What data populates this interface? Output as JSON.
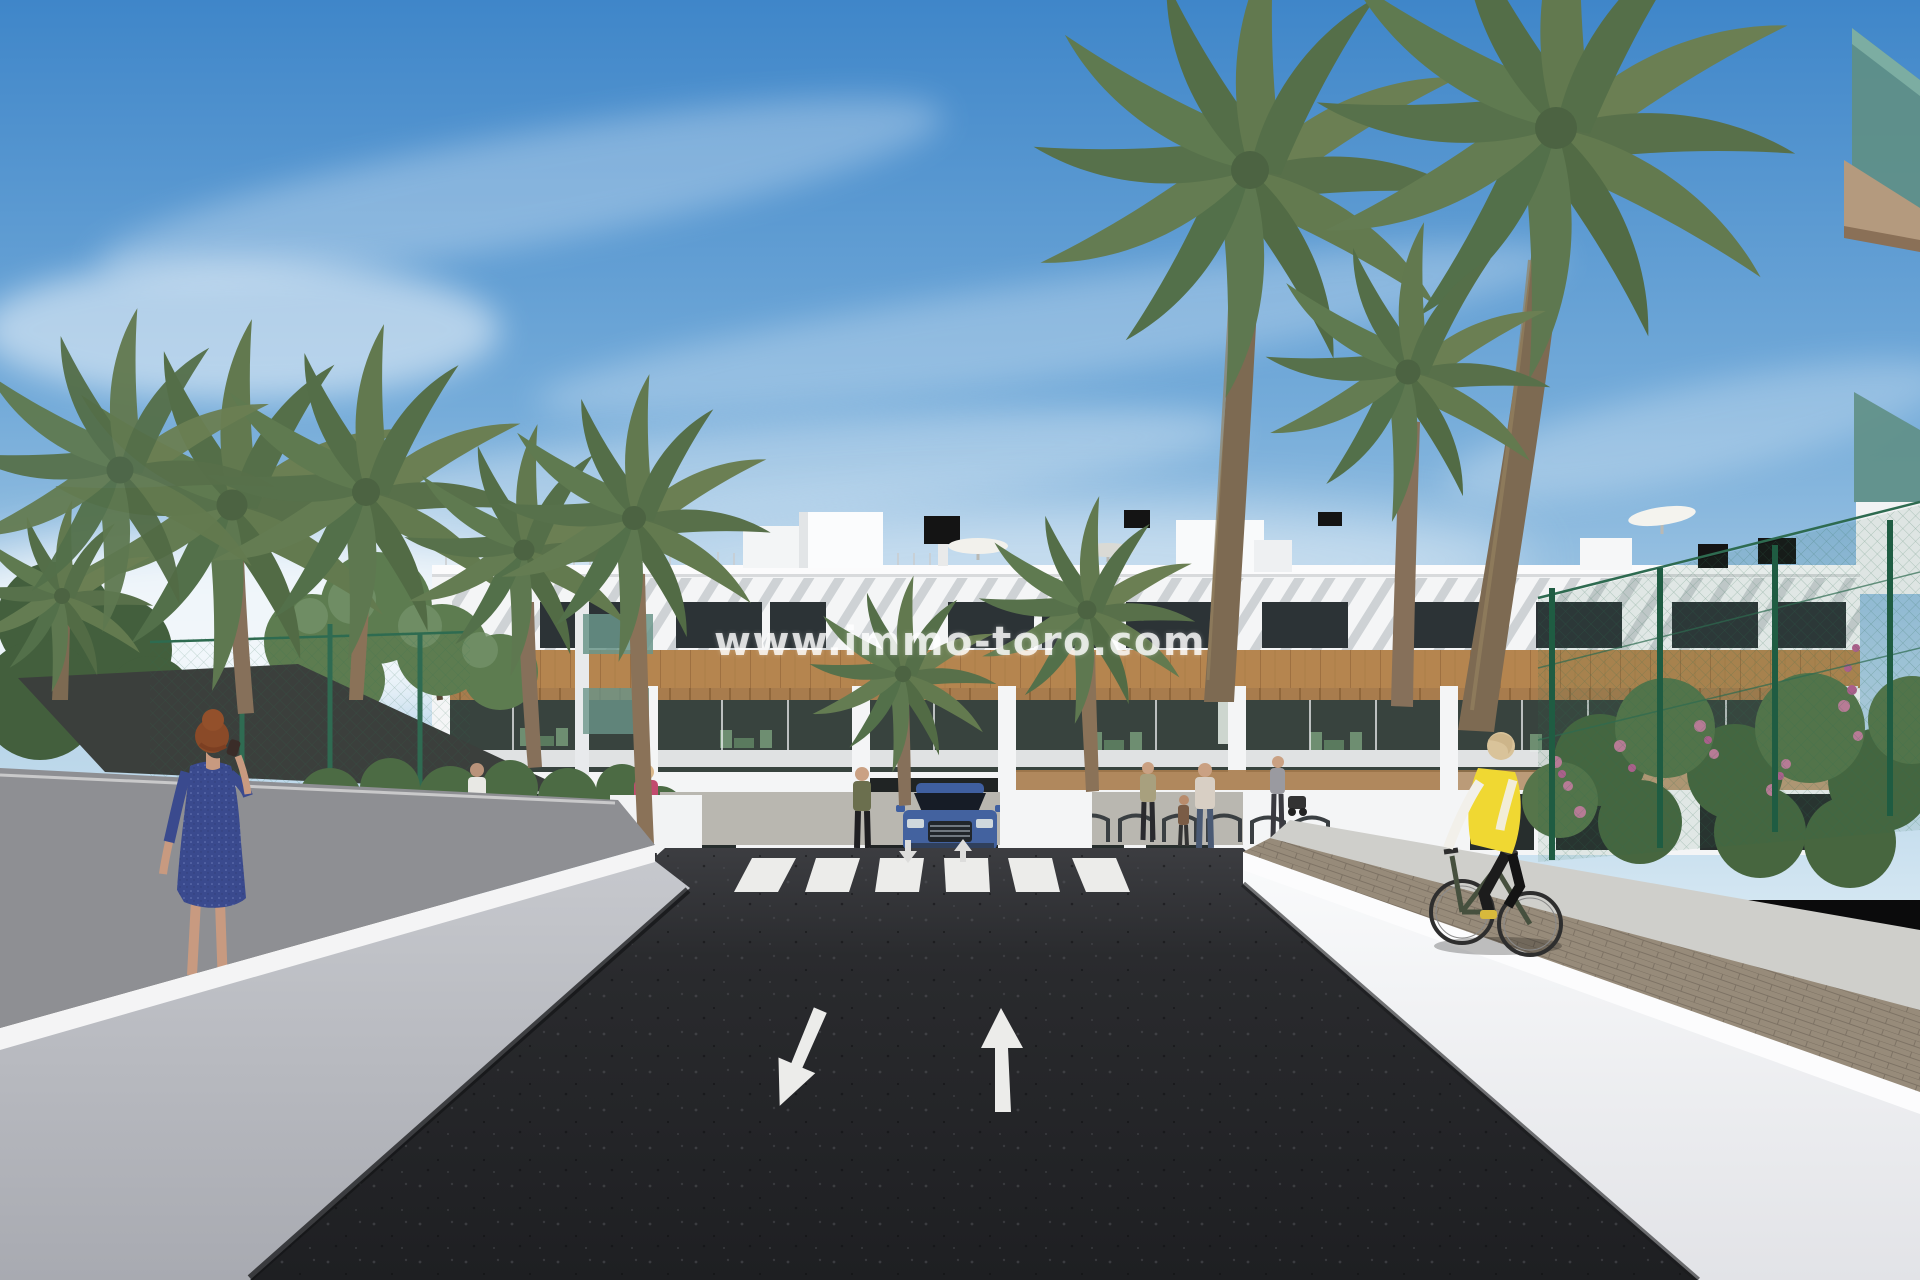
{
  "watermark": {
    "text": "www.immo-toro.com"
  },
  "scene": {
    "setting": "sunny 3D architectural render of a new-build residential street",
    "building": "white three-storey apartment block with timber cladding, pergola balconies and roof terraces",
    "road": {
      "surface": "dark asphalt two-way drive",
      "crosswalk_stripes": 6,
      "lane_arrows": [
        "down-left",
        "up"
      ]
    },
    "vehicle": "blue SUV at the residence entrance",
    "people": [
      "woman in blue dress on phone (left walkway)",
      "cyclist in yellow vest (right walkway)",
      "pedestrians near building entrance"
    ],
    "vegetation": "tall palm trees, leafy trees, hedges with pink and orange flowers"
  },
  "colors": {
    "sky_top": "#3f86c9",
    "sky_horizon": "#d3e6f2",
    "asphalt_light": "#3c3d41",
    "asphalt_dark": "#1e1f22",
    "road_marking": "#ececea",
    "building_white": "#f4f5f6",
    "wood_clad": "#b5854f",
    "wall_left": "#b4b6bc",
    "wall_right": "#f6f7f8",
    "fence_green": "#2e6b50",
    "palm_green": "#5e7850",
    "trunk_brown": "#86705a",
    "car_blue": "#43629f",
    "vest_yellow": "#f0d832",
    "dress_blue": "#3a4a8e",
    "glass_teal": "#6a958a",
    "flower_pink": "#c77d9e",
    "flower_orange": "#d4762a"
  }
}
